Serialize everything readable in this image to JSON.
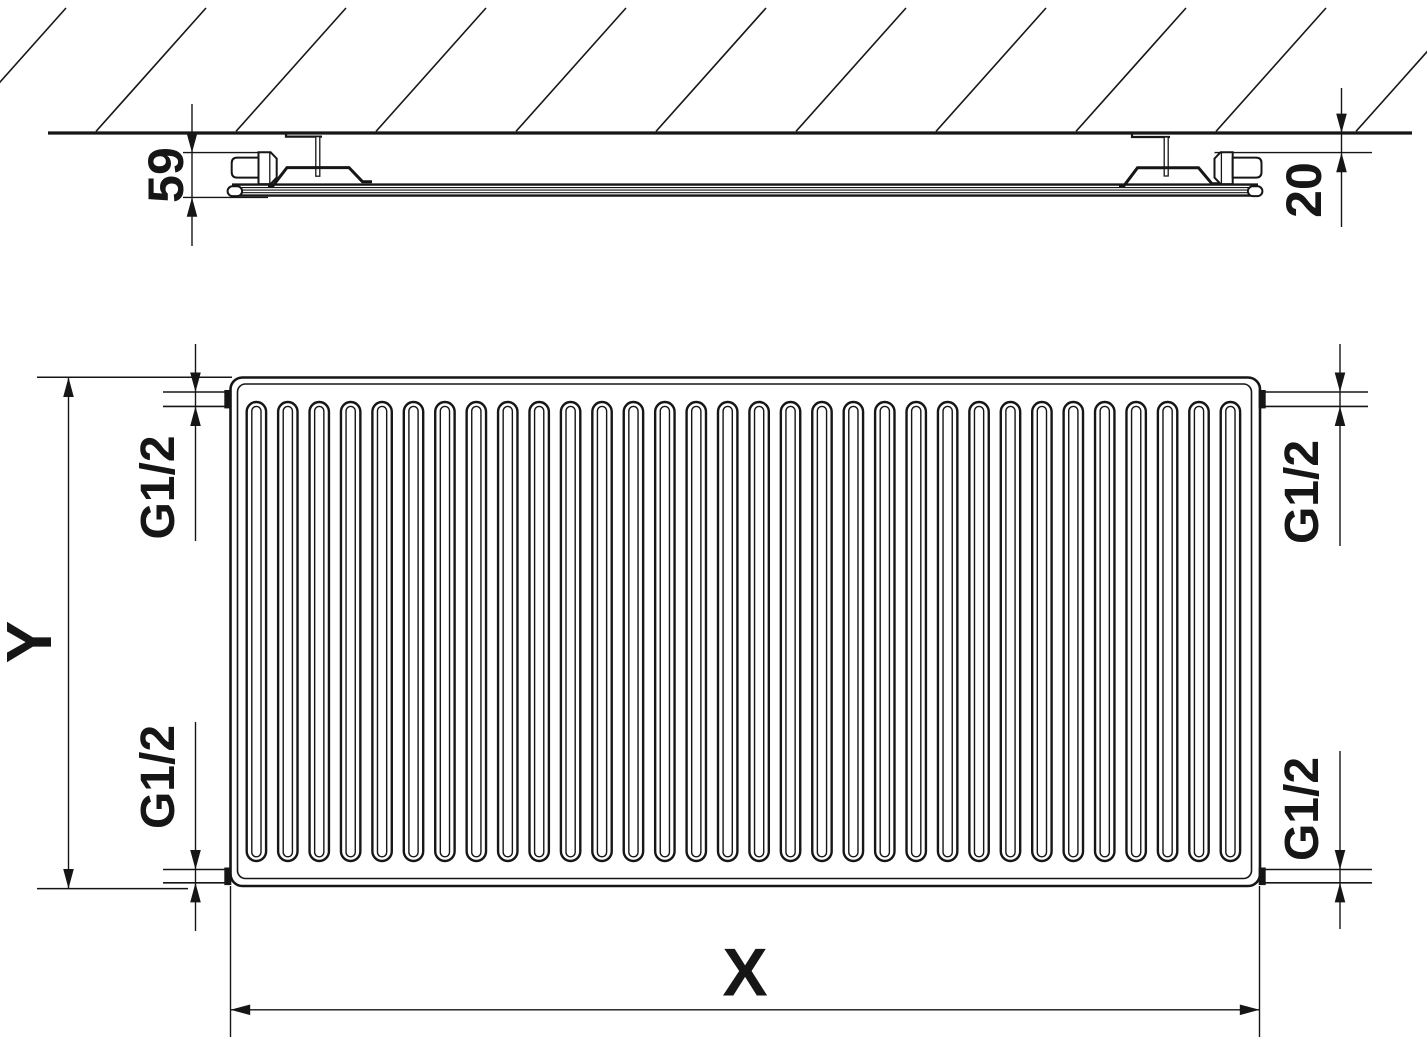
{
  "diagram": {
    "type": "technical-drawing",
    "views": [
      "side-section-at-wall",
      "front-view"
    ]
  },
  "labels": {
    "depth": "59",
    "wall_gap": "20",
    "height": "Y",
    "width": "X",
    "conn_top_left": "G1/2",
    "conn_top_right": "G1/2",
    "conn_bottom_left": "G1/2",
    "conn_bottom_right": "G1/2"
  },
  "front_view": {
    "channel_count": 32,
    "connection_count": 4
  },
  "wall": {
    "hatch_line_count": 11
  },
  "colors": {
    "line": "#161616",
    "background": "#ffffff"
  }
}
